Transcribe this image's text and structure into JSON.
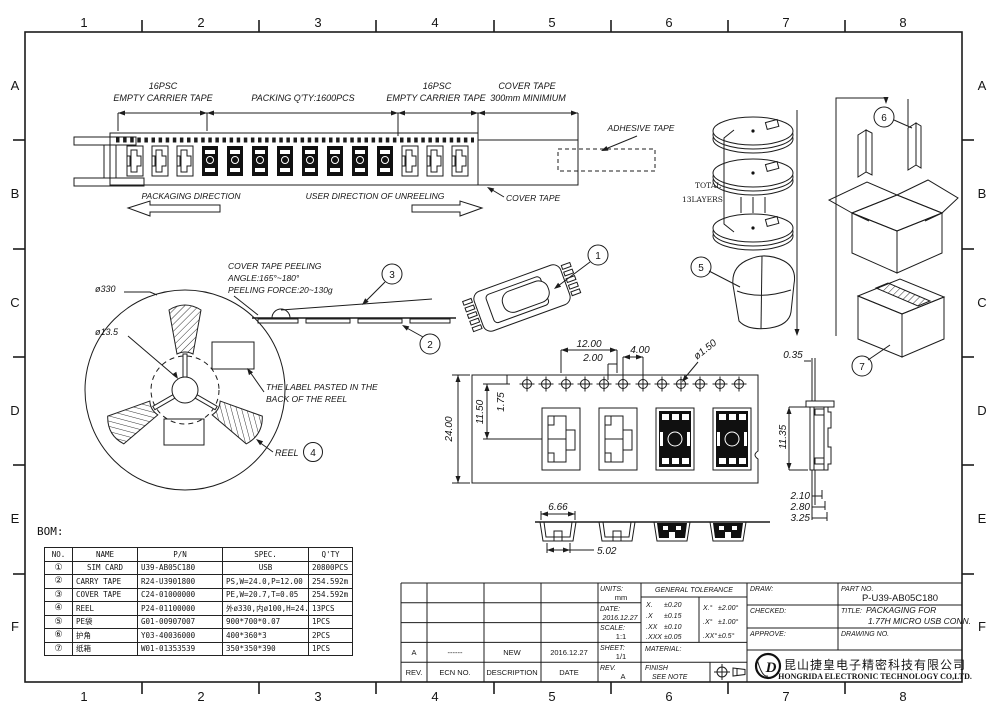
{
  "sheet": {
    "zone_cols": [
      "1",
      "2",
      "3",
      "4",
      "5",
      "6",
      "7",
      "8"
    ],
    "zone_rows": [
      "A",
      "B",
      "C",
      "D",
      "E",
      "F"
    ]
  },
  "tape": {
    "left_16psc": "16PSC",
    "left_empty": "EMPTY CARRIER TAPE",
    "packing_qty": "PACKING Q'TY:1600PCS",
    "right_16psc": "16PSC",
    "right_empty": "EMPTY CARRIER TAPE",
    "cover_top": "COVER TAPE",
    "cover_min": "300mm MINIMIUM",
    "adhesive": "ADHESIVE TAPE",
    "cover_ptr": "COVER TAPE",
    "pack_dir": "PACKAGING DIRECTION",
    "unreel_dir": "USER DIRECTION OF UNREELING"
  },
  "reel": {
    "dia_outer": "ø330",
    "dia_hub": "ø13.5",
    "peel1": "COVER TAPE PEELING",
    "peel2": "ANGLE:165°~180°",
    "peel3": "PEELING FORCE:20~130g",
    "label1": "THE LABEL PASTED IN THE",
    "label2": "BACK OF THE REEL",
    "word": "REEL"
  },
  "stack": {
    "total1": "TOTAL",
    "total2": "13LAYERS"
  },
  "balloons": {
    "n1": "1",
    "n2": "2",
    "n3": "3",
    "n4": "4",
    "n5": "5",
    "n6": "6",
    "n7": "7"
  },
  "dims": {
    "p1200": "12.00",
    "p200": "2.00",
    "p400": "4.00",
    "dia150": "ø1.50",
    "w2400": "24.00",
    "h1150": "11.50",
    "h175": "1.75",
    "t035": "0.35",
    "h1135": "11.35",
    "b210": "2.10",
    "b280": "2.80",
    "b325": "3.25",
    "s666": "6.66",
    "s502": "5.02"
  },
  "bom": {
    "caption": "BOM:",
    "headers": [
      "NO.",
      "NAME",
      "P/N",
      "SPEC.",
      "Q'TY"
    ],
    "rows": [
      [
        "①",
        "SIM CARD",
        "U39-AB05C180",
        "USB",
        "20800PCS"
      ],
      [
        "②",
        "CARRY TAPE",
        "R24-U3901800",
        "PS,W=24.0,P=12.00",
        "254.592m"
      ],
      [
        "③",
        "COVER TAPE",
        "C24-01000000",
        "PE,W=20.7,T=0.05",
        "254.592m"
      ],
      [
        "④",
        "REEL",
        "P24-01100000",
        "外ø330,内ø100,H=24.0",
        "13PCS"
      ],
      [
        "⑤",
        "PE袋",
        "G01-00907007",
        "900*700*0.07",
        "1PCS"
      ],
      [
        "⑥",
        "护角",
        "Y03-40036000",
        "400*360*3",
        "2PCS"
      ],
      [
        "⑦",
        "纸箱",
        "W01-01353539",
        "350*350*390",
        "1PCS"
      ]
    ]
  },
  "rev": {
    "cells": [
      "A",
      "------",
      "NEW",
      "2016.12.27"
    ],
    "headers": [
      "REV.",
      "ECN NO.",
      "DESCRIPTION",
      "DATE"
    ]
  },
  "info": {
    "units_label": "UNITS:",
    "units": "mm",
    "date_label": "DATE:",
    "date": "2016.12.27",
    "scale_label": "SCALE:",
    "scale": "1:1",
    "sheet_label": "SHEET:",
    "sheet": "1/1",
    "rev_label": "REV.",
    "rev": "A"
  },
  "tol": {
    "header": "GENERAL TOLERANCE",
    "lin": [
      [
        "X.",
        "±0.20"
      ],
      [
        ".X",
        "±0.15"
      ],
      [
        ".XX",
        "±0.10"
      ],
      [
        ".XXX",
        "±0.05"
      ]
    ],
    "ang": [
      [
        "X.°",
        "±2.00°"
      ],
      [
        ".X°",
        "±1.00°"
      ],
      [
        ".XX°",
        "±0.5°"
      ]
    ],
    "material": "MATERIAL:",
    "finish1": "FINISH",
    "finish2": "SEE NOTE"
  },
  "sign": {
    "draw": "DRAW:",
    "checked": "CHECKED:",
    "approve": "APPROVE:",
    "part_label": "PART NO.",
    "part_no": "P-U39-AB05C180",
    "title_label": "TITLE:",
    "title1": "PACKAGING FOR",
    "title2": "1.77H MICRO USB CONN.",
    "drawing_label": "DRAWING NO."
  },
  "company": {
    "cn": "昆山捷皇电子精密科技有限公司",
    "en": "HONGRIDA ELECTRONIC TECHNOLOGY CO,LTD."
  }
}
